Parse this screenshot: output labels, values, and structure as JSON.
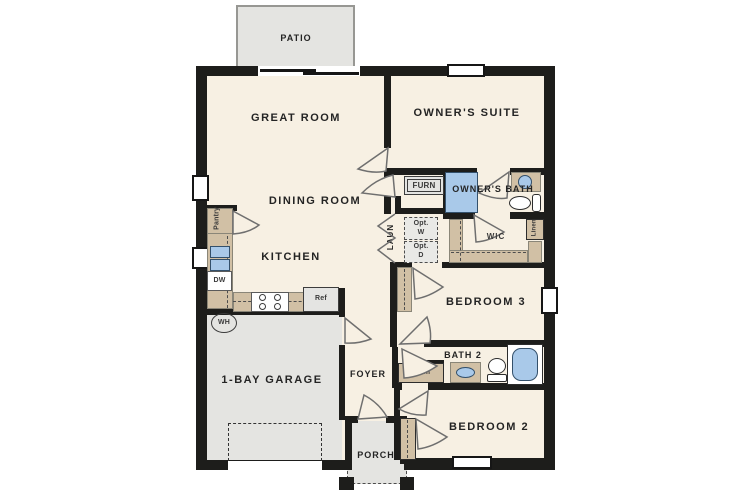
{
  "labels": {
    "patio": "PATIO",
    "great_room": "GREAT ROOM",
    "owners_suite": "OWNER'S SUITE",
    "dining_room": "DINING ROOM",
    "kitchen": "KITCHEN",
    "garage": "1-BAY GARAGE",
    "foyer": "FOYER",
    "porch": "PORCH",
    "bedroom3": "BEDROOM 3",
    "bedroom2": "BEDROOM 2",
    "bath2": "BATH 2",
    "wic": "WIC",
    "owners_bath": "OWNER'S BATH",
    "laundry": "LAUN",
    "furnace": "FURN",
    "opt_washer": "Opt. W",
    "opt_dryer": "Opt. D",
    "linen_wic": "Linen",
    "linen_bath2": "Linen",
    "pantry": "Pantry",
    "water_heater": "WH",
    "dishwasher": "DW",
    "refrigerator": "Ref"
  },
  "colors": {
    "wall": "#1d1d1b",
    "interior_floor": "#f7f0e3",
    "concrete": "#e4e4e1",
    "casework_tan": "#d1c0a5",
    "fixture_blue": "#a9c9e9"
  }
}
